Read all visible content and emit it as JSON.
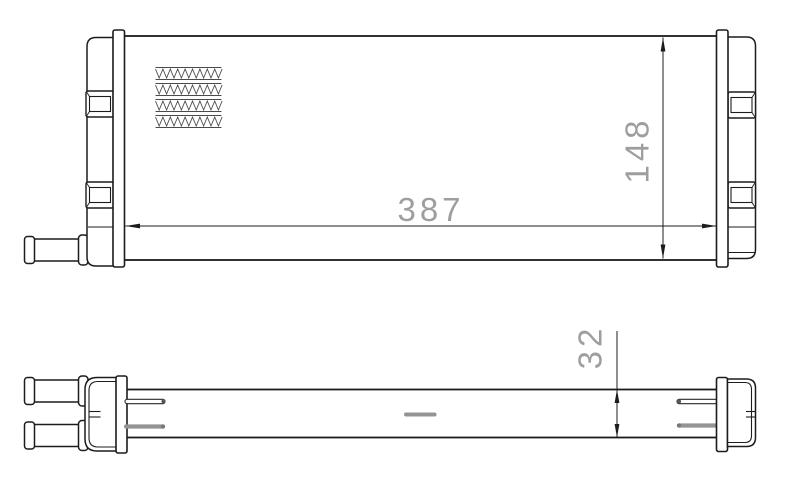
{
  "drawing": {
    "kind": "technical-drawing",
    "subject": "heat-exchanger-heater-core",
    "background": "#ffffff",
    "dimensions": {
      "width": "387",
      "height": "148",
      "depth": "32"
    },
    "features": {
      "fin_rows": 4,
      "views": [
        "front",
        "bottom-profile"
      ]
    },
    "colors": {
      "outline": "#1c1c1c",
      "dim_text": "#9e9e9e",
      "gray_detail": "#949494"
    }
  }
}
